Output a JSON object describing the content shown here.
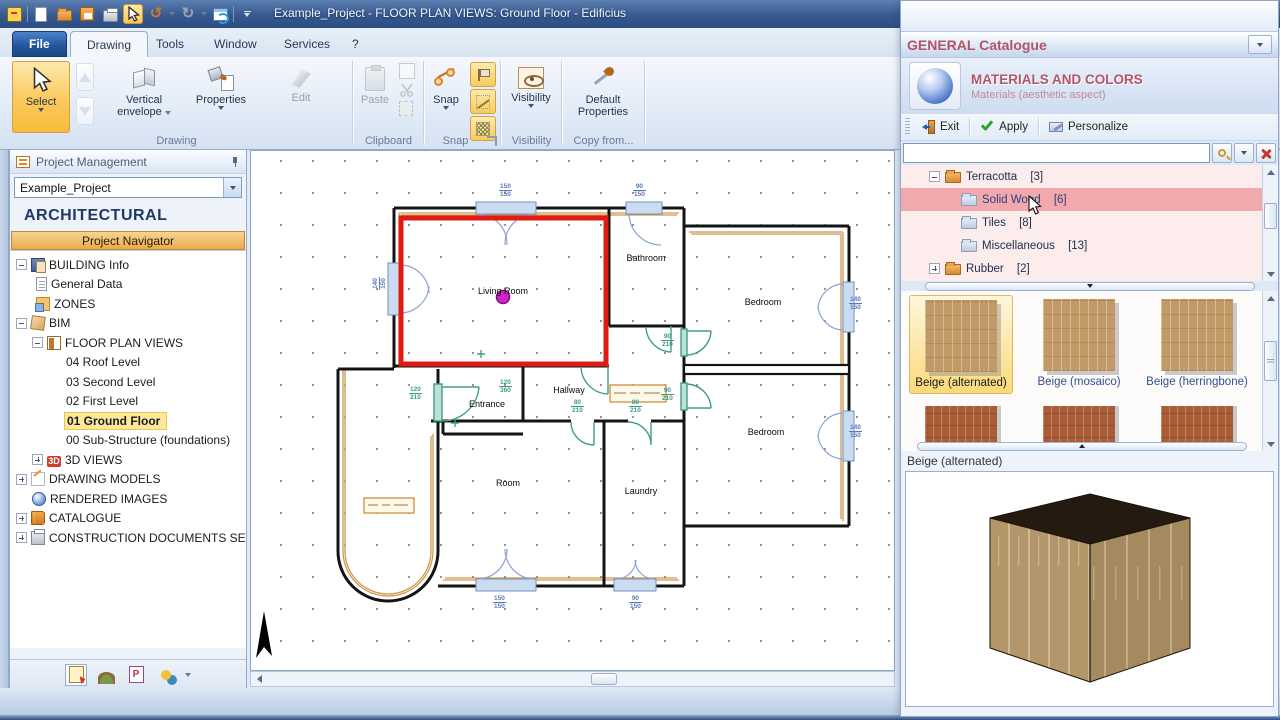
{
  "window": {
    "title": "Example_Project -  FLOOR PLAN VIEWS: Ground Floor - Edificius"
  },
  "tabs": {
    "file": "File",
    "drawing": "Drawing",
    "tools": "Tools",
    "window": "Window",
    "services": "Services",
    "help": "?"
  },
  "ribbon": {
    "select": "Select",
    "vertical_envelope_1": "Vertical",
    "vertical_envelope_2": "envelope",
    "properties": "Properties",
    "edit": "Edit",
    "paste": "Paste",
    "snap": "Snap",
    "visibility": "Visibility",
    "default_properties_1": "Default",
    "default_properties_2": "Properties",
    "groups": {
      "drawing": "Drawing",
      "clipboard": "Clipboard",
      "snap": "Snap",
      "visibility": "Visibility",
      "copy_from": "Copy from..."
    }
  },
  "sidebar": {
    "header": "Project Management",
    "project": "Example_Project",
    "section": "ARCHITECTURAL",
    "navigator": "Project Navigator",
    "glyph_3d": "3D",
    "tree": [
      {
        "label": "BUILDING Info"
      },
      {
        "label": "General Data"
      },
      {
        "label": "ZONES"
      },
      {
        "label": "BIM"
      },
      {
        "label": "FLOOR PLAN VIEWS"
      },
      {
        "label": "04 Roof Level"
      },
      {
        "label": "03 Second Level"
      },
      {
        "label": "02 First Level"
      },
      {
        "label": "01 Ground Floor",
        "selected": true
      },
      {
        "label": "00 Sub-Structure (foundations)"
      },
      {
        "label": "3D VIEWS"
      },
      {
        "label": "DRAWING MODELS"
      },
      {
        "label": "RENDERED IMAGES"
      },
      {
        "label": "CATALOGUE"
      },
      {
        "label": "CONSTRUCTION DOCUMENTS SET"
      }
    ]
  },
  "plan": {
    "rooms": [
      {
        "name": "Living Room"
      },
      {
        "name": "Bathroom"
      },
      {
        "name": "Bedroom"
      },
      {
        "name": "Bedroom"
      },
      {
        "name": "Hallway"
      },
      {
        "name": "Entrance"
      },
      {
        "name": "Room"
      },
      {
        "name": "Laundry"
      }
    ],
    "dims": [
      {
        "a": "150",
        "b": "150"
      },
      {
        "a": "90",
        "b": "150"
      },
      {
        "a": "140",
        "b": "150"
      },
      {
        "a": "140",
        "b": "150"
      },
      {
        "a": "140",
        "b": "150"
      },
      {
        "a": "120",
        "b": "210"
      },
      {
        "a": "120",
        "b": "360"
      },
      {
        "a": "80",
        "b": "210"
      },
      {
        "a": "80",
        "b": "210"
      },
      {
        "a": "90",
        "b": "210"
      },
      {
        "a": "90",
        "b": "210"
      },
      {
        "a": "150",
        "b": "150"
      },
      {
        "a": "90",
        "b": "150"
      }
    ]
  },
  "catalogue": {
    "title": "GENERAL Catalogue",
    "header": "MATERIALS AND COLORS",
    "subheader": "Materials (aesthetic aspect)",
    "toolbar": {
      "exit": "Exit",
      "apply": "Apply",
      "personalize": "Personalize"
    },
    "search_value": "",
    "tree": [
      {
        "label": "Terracotta",
        "count": "[3]"
      },
      {
        "label": "Solid Wood",
        "count": "[6]",
        "selected": true
      },
      {
        "label": "Tiles",
        "count": "[8]"
      },
      {
        "label": "Miscellaneous",
        "count": "[13]"
      },
      {
        "label": "Rubber",
        "count": "[2]"
      }
    ],
    "thumbnails": [
      {
        "label": "Beige (alternated)",
        "selected": true
      },
      {
        "label": "Beige (mosaico)"
      },
      {
        "label": "Beige (herringbone)"
      }
    ],
    "preview_label": "Beige (alternated)"
  }
}
